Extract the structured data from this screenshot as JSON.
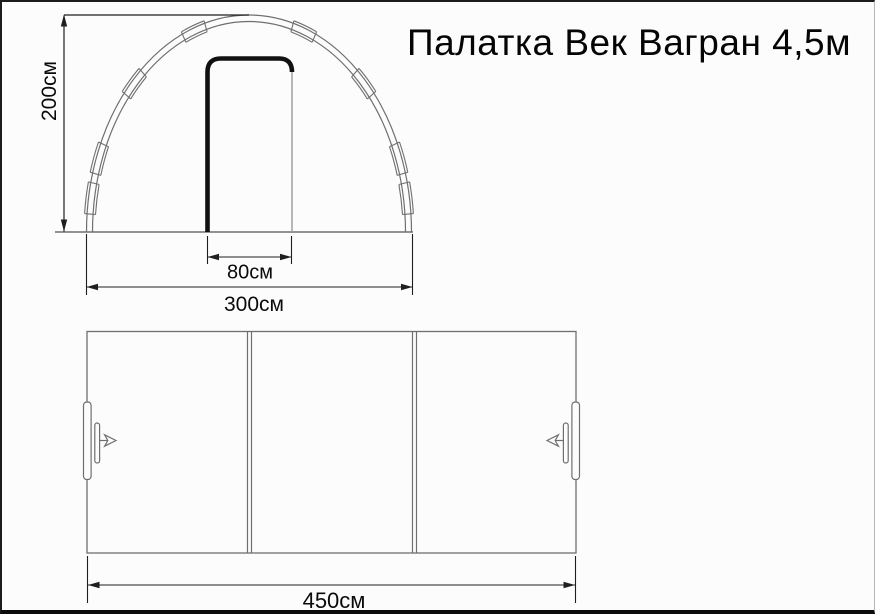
{
  "title": "Палатка Век Вагран 4,5м",
  "dimensions": {
    "height": "200см",
    "door_width": "80см",
    "width": "300см",
    "length": "450см"
  },
  "colors": {
    "line_gray": "#6f6f6f",
    "dimension_black": "#1f1f1f",
    "door_black": "#111111",
    "background": "#fcfcfc"
  }
}
